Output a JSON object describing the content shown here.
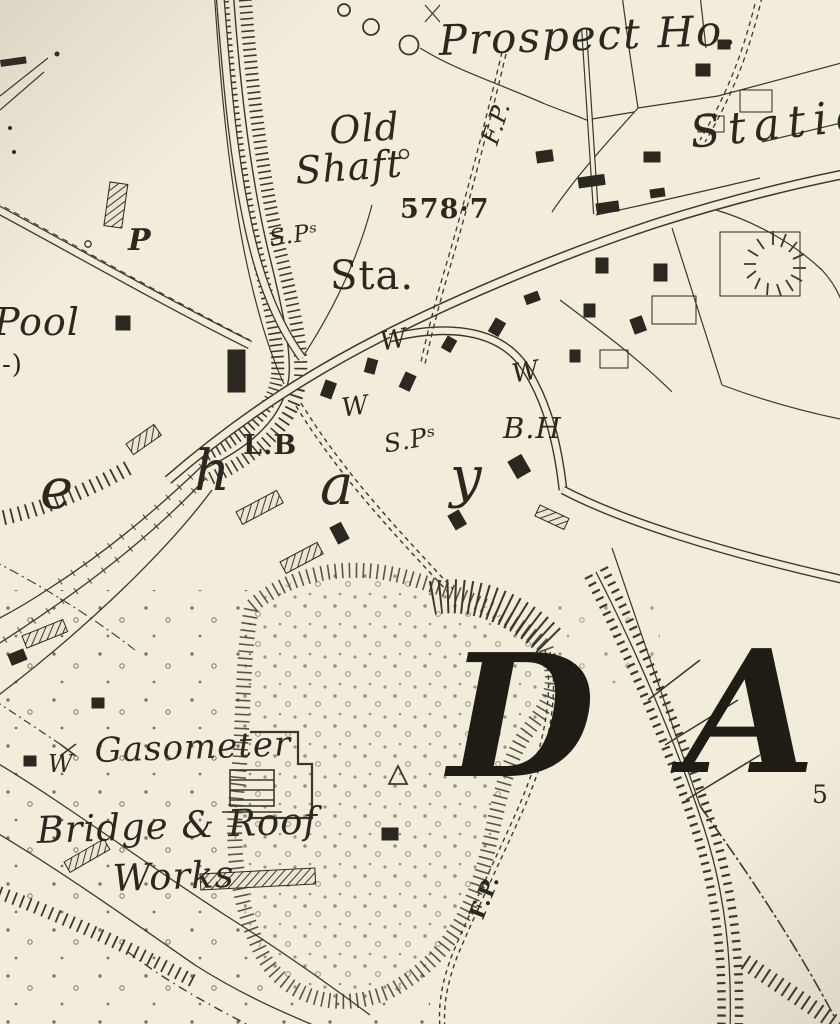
{
  "map": {
    "type": "historic-ordnance-survey-map-extract",
    "colors": {
      "paper": "#f2edda",
      "ink": "#3b372f",
      "label_ink": "#2c2821",
      "district_letter_ink": "#1f1b15"
    },
    "labels": {
      "prospect_house": "Prospect Ho.",
      "footpath_upper": "F.P.",
      "old_shaft_line1": "Old",
      "old_shaft_line2": "Shaft",
      "spot_height": "578·7",
      "station_partial": "Statio",
      "signal_posts_upper": "S.Pˢ",
      "station_abbrev": "Sta.",
      "pump": "P",
      "pool": "Pool",
      "pool_continuation": "-)",
      "placename_letter_e": "e",
      "placename_letter_h": "h",
      "placename_letter_a": "a",
      "placename_letter_y": "y",
      "letter_box": "L.B",
      "well_upper": "W",
      "well_mid": "W",
      "well_right": "W",
      "signal_posts_lower": "S.Pˢ",
      "beer_house": "B.H",
      "district_letter_d": "D",
      "district_letter_a": "A",
      "gasometer": "Gasometer",
      "well_gasworks": "W",
      "works_name_line1": "Bridge & Roof",
      "works_name_line2": "Works",
      "footpath_lower": "F.P.",
      "partial_number": "5"
    }
  }
}
